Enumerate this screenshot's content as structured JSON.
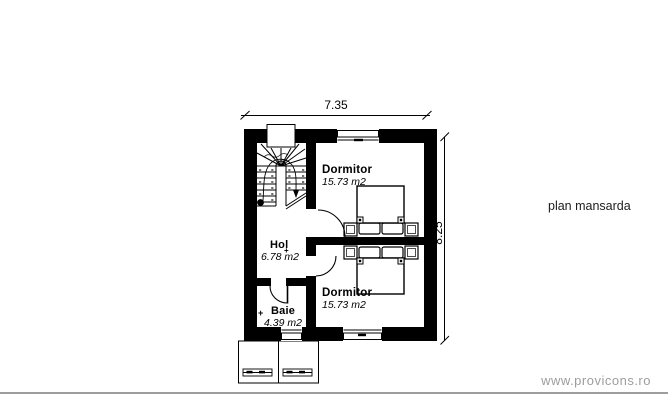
{
  "page": {
    "plan_title": "plan mansarda",
    "footer_url": "www.provicons.ro"
  },
  "dimensions": {
    "width": "7.35",
    "height": "8.25"
  },
  "rooms": {
    "dormitor_top": {
      "name": "Dormitor",
      "area": "15.73 m2"
    },
    "dormitor_bottom": {
      "name": "Dormitor",
      "area": "15.73 m2"
    },
    "hol": {
      "name": "Hol",
      "area": "6.78 m2"
    },
    "baie": {
      "name": "Baie",
      "area": "4.39 m2"
    }
  },
  "markers": {
    "cross": "+"
  },
  "colors": {
    "wall": "#000000",
    "line": "#000000",
    "title_text": "#1c1c1c",
    "footer_text": "#9d9d9d",
    "footer_rule": "#9d9d9d",
    "background": "#ffffff"
  }
}
